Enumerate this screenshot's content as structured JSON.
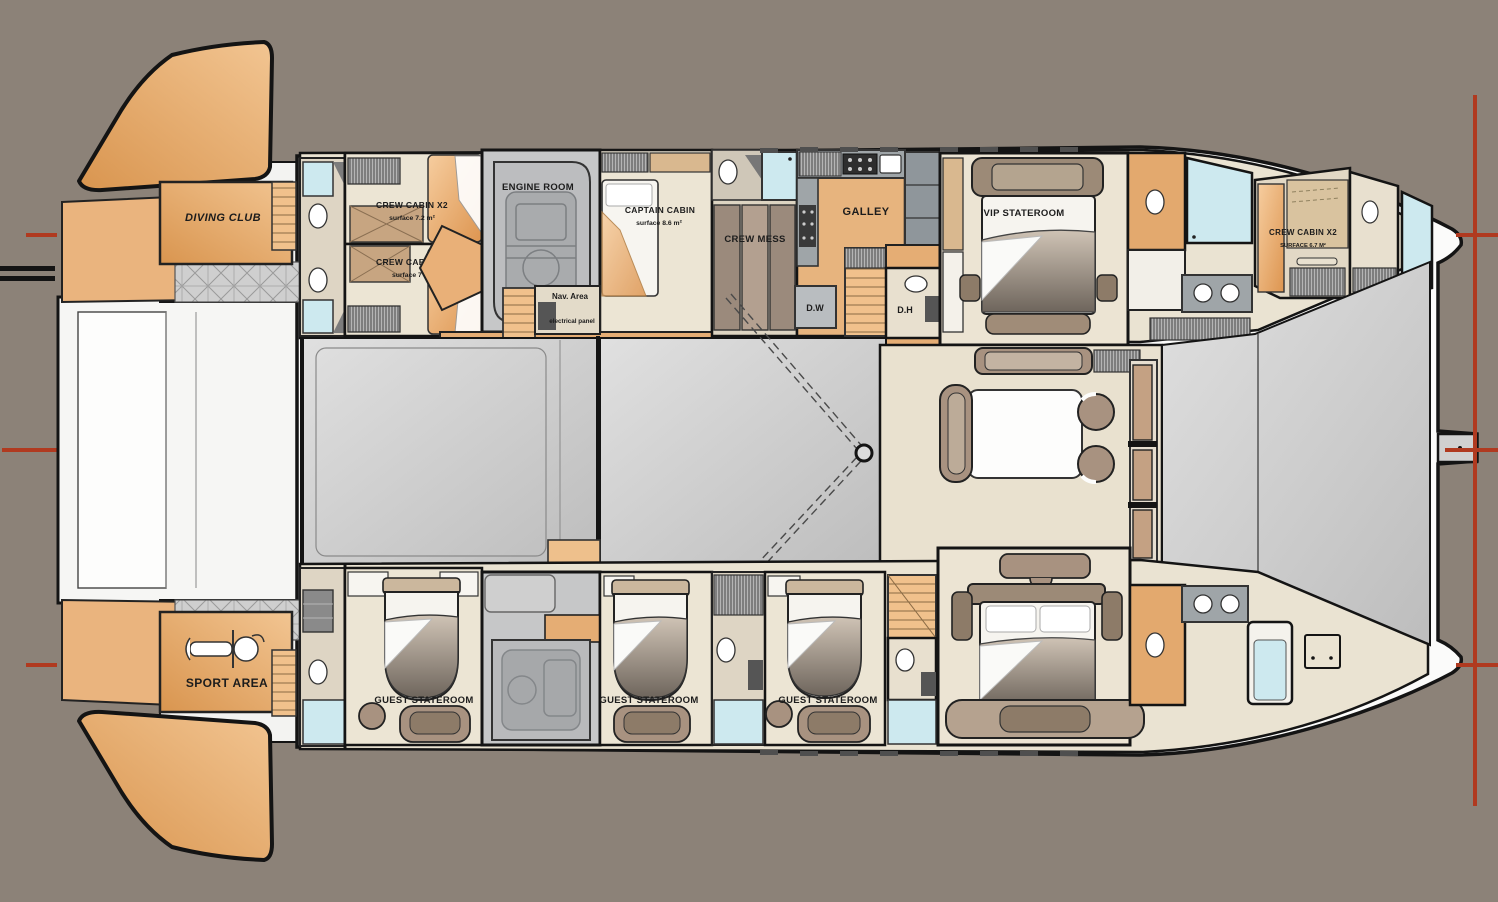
{
  "drawing": {
    "type": "yacht-catamaran-deck-floor-plan",
    "colors": {
      "background": "#8c8278",
      "hull_white": "#fbfbfa",
      "outline_black": "#141414",
      "deck_gray_light": "#dedede",
      "deck_gray_dark": "#bdbdbd",
      "room_beige": "#eae3d2",
      "orange_light": "#f2c08a",
      "orange_dark": "#d9944f",
      "corridor_orange": "#e5ad74",
      "furniture_brown": "#a89280",
      "headboard_brown": "#9c8a77",
      "counter_gray": "#9fa5a8",
      "engine_gray": "#c6c7c8",
      "shower_blue": "#cde9ef",
      "reference_red": "#b03a20"
    }
  },
  "rooms": {
    "diving_club": {
      "label": "DIVING CLUB"
    },
    "crew_cabin_aft_upper": {
      "label": "CREW CABIN X2",
      "surface": "surface 7.2 m²"
    },
    "crew_cabin_aft_lower": {
      "label": "CREW CABIN X2",
      "surface": "surface 7 m²"
    },
    "engine_room": {
      "label": "ENGINE ROOM"
    },
    "captain_cabin": {
      "label": "CAPTAIN CABIN",
      "surface": "surface 8.6 m²"
    },
    "nav_area": {
      "label": "Nav. Area",
      "sublabel": "electrical panel"
    },
    "crew_mess": {
      "label": "CREW MESS"
    },
    "galley": {
      "label": "GALLEY"
    },
    "dishwasher": {
      "label": "D.W"
    },
    "day_head": {
      "label": "D.H"
    },
    "vip_stateroom": {
      "label": "VIP STATEROOM"
    },
    "crew_cabin_bow": {
      "label": "CREW CABIN X2",
      "surface": "SURFACE 6.7 M²"
    },
    "sport_area": {
      "label": "SPORT AREA"
    },
    "guest_stateroom_1": {
      "label": "GUEST STATEROOM"
    },
    "guest_stateroom_2": {
      "label": "GUEST STATEROOM"
    },
    "guest_stateroom_3": {
      "label": "GUEST STATEROOM"
    }
  }
}
